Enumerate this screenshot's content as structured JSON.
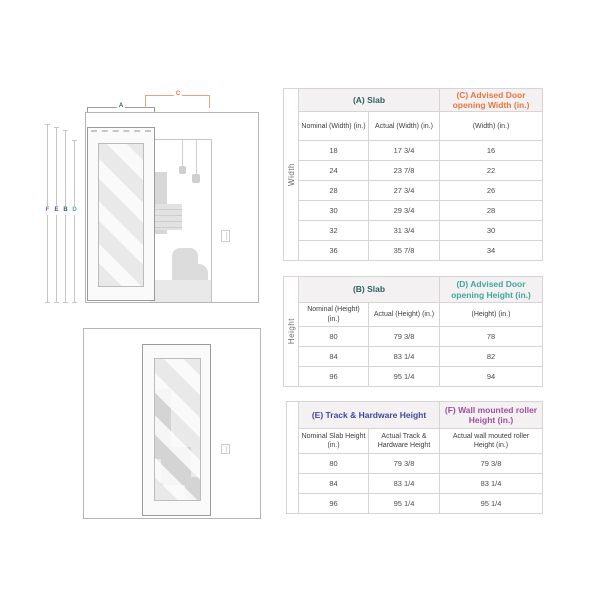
{
  "colors": {
    "slab_teal_dark": "#2e6260",
    "advised_width_orange": "#e8763f",
    "advised_height_teal": "#3fa89f",
    "track_indigo": "#45479e",
    "roller_purple": "#a04fa0"
  },
  "diagram": {
    "width_dims": [
      {
        "label": "A",
        "color": "#2e6260"
      },
      {
        "label": "C",
        "color": "#e8763f"
      }
    ],
    "height_dims": [
      {
        "label": "F",
        "color": "#a04fa0"
      },
      {
        "label": "E",
        "color": "#45479e"
      },
      {
        "label": "B",
        "color": "#2e6260"
      },
      {
        "label": "D",
        "color": "#3fa89f"
      }
    ]
  },
  "tables": [
    {
      "side_label": "Width",
      "group_headers": [
        {
          "label": "(A) Slab",
          "color": "#2e6260"
        },
        {
          "label": "(C) Advised Door opening Width (in.)",
          "color": "#e8763f"
        }
      ],
      "col_headers": [
        "Nominal (Width) (in.)",
        "Actual (Width) (in.)",
        "(Width) (in.)"
      ],
      "rows": [
        [
          "18",
          "17 3/4",
          "16"
        ],
        [
          "24",
          "23 7/8",
          "22"
        ],
        [
          "28",
          "27 3/4",
          "26"
        ],
        [
          "30",
          "29 3/4",
          "28"
        ],
        [
          "32",
          "31 3/4",
          "30"
        ],
        [
          "36",
          "35 7/8",
          "34"
        ]
      ]
    },
    {
      "side_label": "Height",
      "group_headers": [
        {
          "label": "(B) Slab",
          "color": "#2e6260"
        },
        {
          "label": "(D) Advised Door opening Height (in.)",
          "color": "#3fa89f"
        }
      ],
      "col_headers": [
        "Nominal (Height) (in.)",
        "Actual (Height) (in.)",
        "(Height) (in.)"
      ],
      "rows": [
        [
          "80",
          "79 3/8",
          "78"
        ],
        [
          "84",
          "83 1/4",
          "82"
        ],
        [
          "96",
          "95 1/4",
          "94"
        ]
      ]
    },
    {
      "side_label": "",
      "group_headers": [
        {
          "label": "(E) Track & Hardware Height",
          "color": "#45479e"
        },
        {
          "label": "(F) Wall mounted roller Height (in.)",
          "color": "#a04fa0"
        }
      ],
      "col_headers": [
        "Nominal Slab Height (in.)",
        "Actual Track & Hardware Height",
        "Actual wall mouted roller Height (in.)"
      ],
      "rows": [
        [
          "80",
          "79 3/8",
          "79 3/8"
        ],
        [
          "84",
          "83 1/4",
          "83 1/4"
        ],
        [
          "96",
          "95 1/4",
          "95 1/4"
        ]
      ]
    }
  ]
}
